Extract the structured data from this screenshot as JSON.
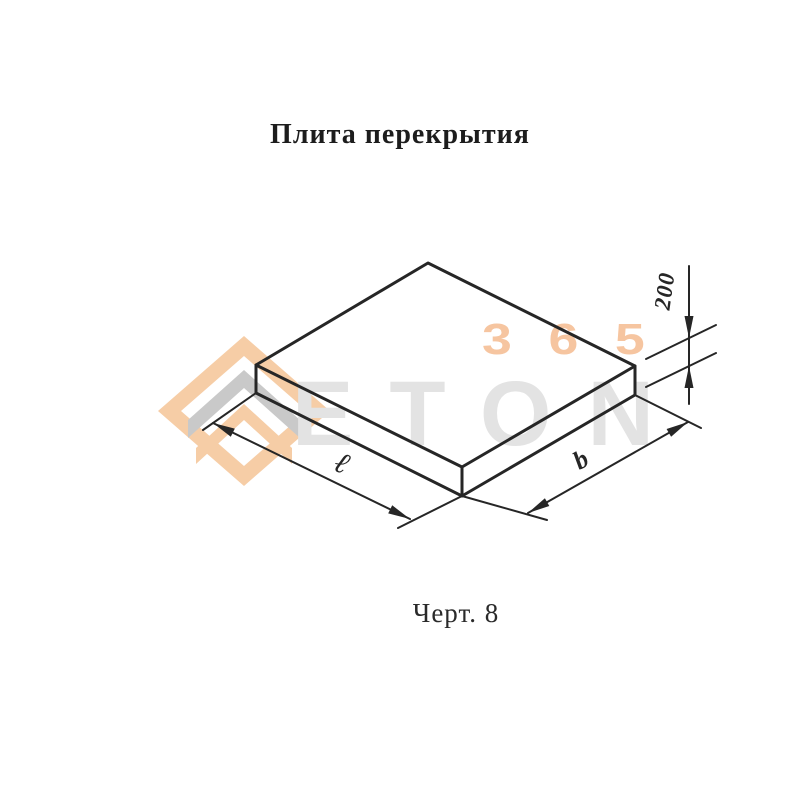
{
  "title": "Плита перекрытия",
  "caption": "Черт. 8",
  "drawing": {
    "subject": "floor-slab-isometric-view",
    "labels": {
      "length": "ℓ",
      "width": "b",
      "thickness": "200"
    }
  },
  "watermark": {
    "logo": "eton-chevron-logo",
    "brand": "ETON",
    "number": "365"
  },
  "colors": {
    "line": "#262626",
    "watermark_brand_gray": "#e3e3e3",
    "watermark_accent_peach": "#f6c5a0",
    "logo_peach": "#f6cda6",
    "logo_gray": "#c9c9c9",
    "logo_white": "#ffffff"
  }
}
